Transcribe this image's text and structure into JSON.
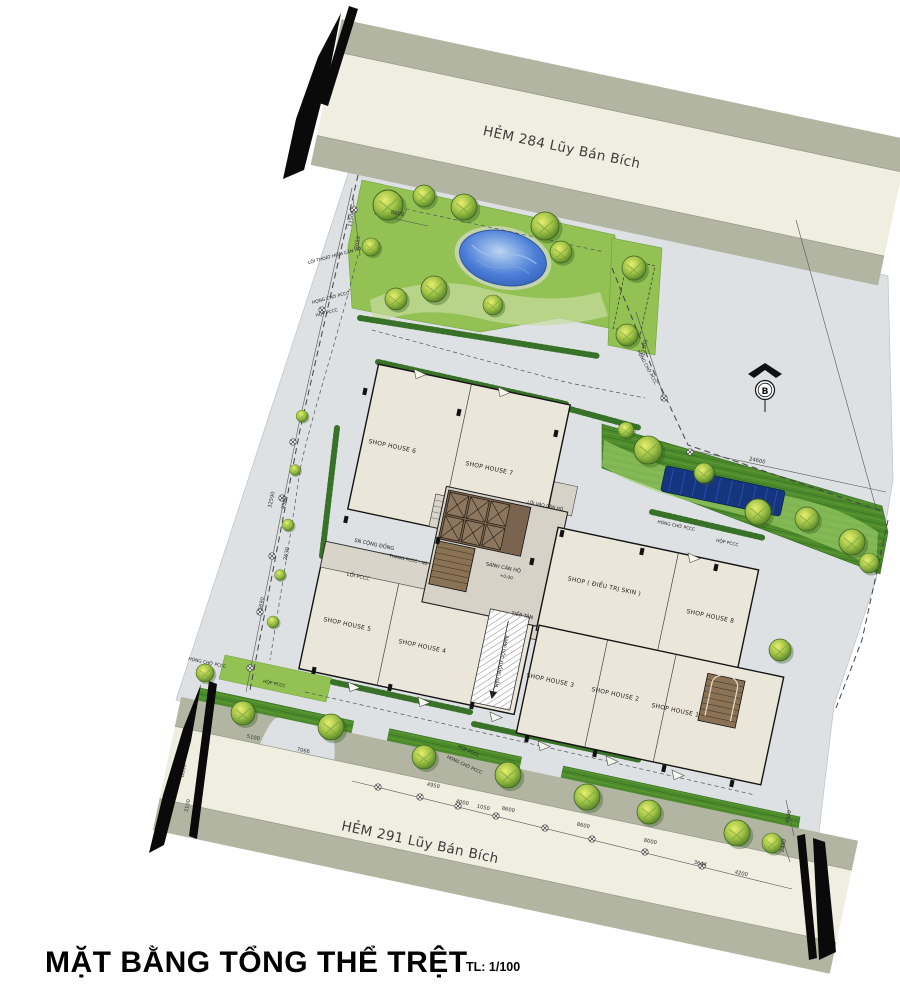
{
  "title": {
    "main": "MẶT BẰNG TỔNG THỂ TRỆT",
    "scale": "TL: 1/100"
  },
  "roads": {
    "top": "HẺM 284 Lũy Bán Bích",
    "bottom": "HẺM 291 Lũy Bán Bích"
  },
  "north_indicator": "B",
  "units": {
    "sh1": "SHOP HOUSE 1",
    "sh2": "SHOP HOUSE 2",
    "sh3": "SHOP HOUSE 3",
    "sh4": "SHOP HOUSE 4",
    "sh5": "SHOP HOUSE 5",
    "sh6": "SHOP HOUSE 6",
    "sh7": "SHOP HOUSE 7",
    "sh8": "SHOP HOUSE 8",
    "shop_skin": "SHOP ( ĐIỀU TRỊ SKIN )"
  },
  "areas": {
    "lobby": "SẢNH CĂN HỘ",
    "lobby_level": "+0.00",
    "reception": "TIẾP TÂN",
    "ramp": "RAMP DỐC XUỐNG HẦM",
    "community_yard": "SN CỘNG ĐỒNG",
    "fire_stair": "THANG PCCC - N2",
    "fire_lane": "LỐI PCCC",
    "apartment_entry": "LỐI VÀO CĂN HỘ",
    "apartment_escape": "LỐI THOÁT HIỂM CĂN HỘ"
  },
  "fire": {
    "hydrant": "HỌNG CHỜ PCCC",
    "box": "HỘP PCCC"
  },
  "dims": [
    "11500",
    "2050",
    "8600",
    "21500",
    "24600",
    "32590",
    "9560",
    "2630",
    "5690",
    "3600",
    "6000",
    "3100",
    "5100",
    "7066",
    "4950",
    "4000",
    "1050",
    "8600",
    "8600",
    "8000",
    "3644",
    "4500",
    "2440",
    "4200"
  ],
  "colors": {
    "paving": "#dde1e4",
    "road": "#efeee1",
    "sidewalk": "#b3b5a3",
    "grass": "#93c153",
    "grass_dark": "#4c8a2c",
    "pool": "#3a6fd1",
    "water": "#16357f",
    "building": "#eae6da",
    "core": "#8a7355",
    "line": "#1a1a1a"
  }
}
